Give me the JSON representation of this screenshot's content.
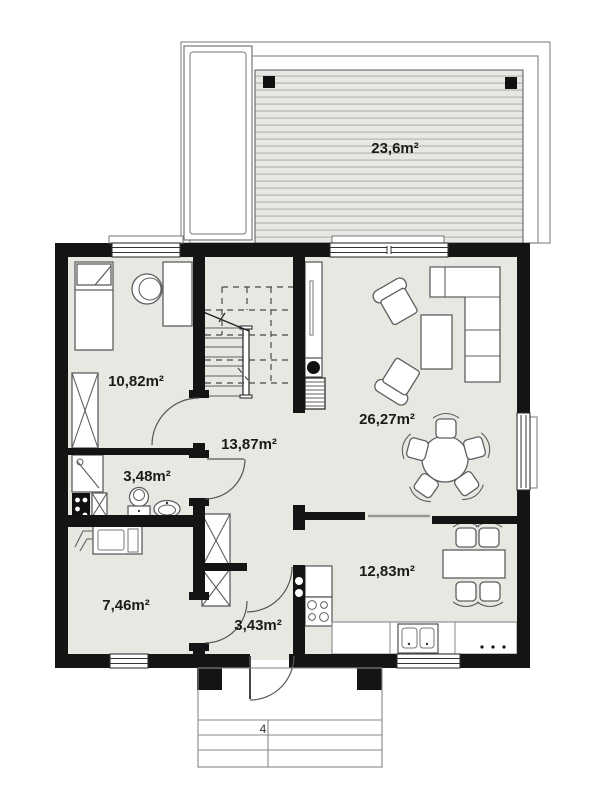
{
  "plan": {
    "labels": {
      "terrace": "23,6m²",
      "bedroom": "10,82m²",
      "hall": "13,87m²",
      "living_room": "26,27m²",
      "bathroom": "3,48m²",
      "utility": "7,46m²",
      "vestibule": "3,43m²",
      "kitchen": "12,83m²",
      "steps_count": "4"
    },
    "colors": {
      "wall": "#141414",
      "floor": "#e8e7e2",
      "terrace_fill": "#e7e7e3",
      "terrace_stripe": "#bcbcb8",
      "furniture_stroke": "#5f5f5f",
      "label_text": "#1b1b1b"
    }
  }
}
